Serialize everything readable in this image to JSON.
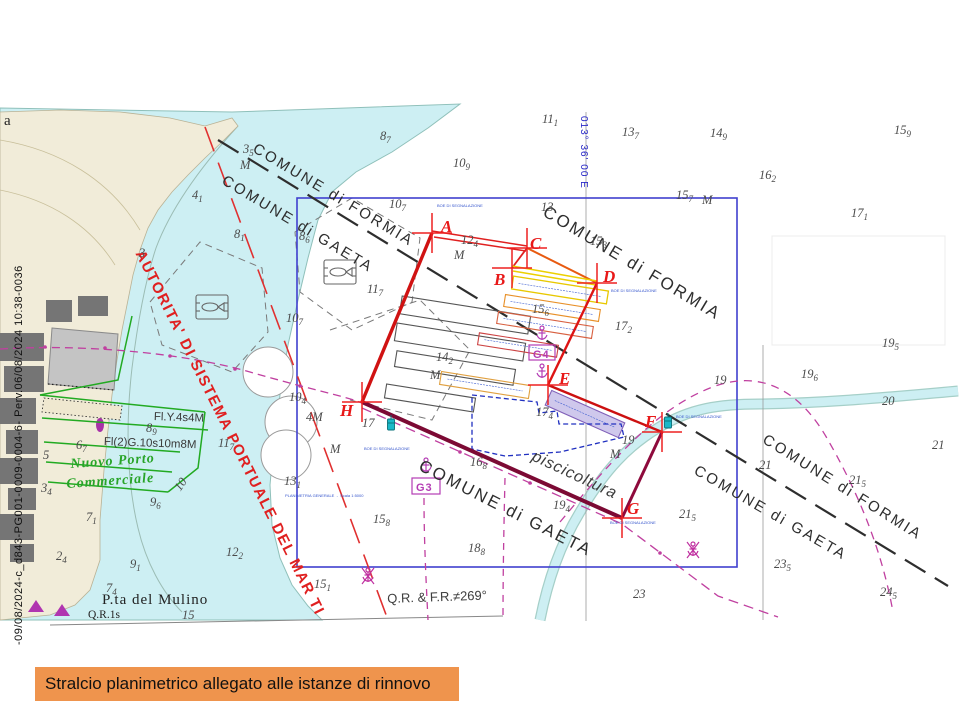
{
  "page": {
    "caption": "Stralcio planimetrico allegato alle istanze di rinnovo",
    "reference_vertical": "-09/08/2024-c_d843-PG001-0009-0004-6- Perv.06/08/2024 10:38-0036"
  },
  "colors": {
    "caption_bg": "#ef944d",
    "shallow_water": "#cdeff3",
    "land": "#f1ecd9",
    "polygon_red": "#d01212",
    "polygon_dark": "#7c0a34",
    "cage_yellow": "#e8c800",
    "cage_orange": "#e89028",
    "magenta_cable": "#c040a0",
    "frame_blue": "#4040cf",
    "authority_red": "#e02020",
    "green_port": "#28a428",
    "buoy_teal": "#1ab8c8"
  },
  "chart": {
    "labels": [
      {
        "name": "comune-formia-1",
        "text": "COMUNE di FORMIA",
        "x": 258,
        "y": 141,
        "rot": 31,
        "cls": "comune"
      },
      {
        "name": "comune-gaeta-1",
        "text": "COMUNE di GAETA",
        "x": 227,
        "y": 173,
        "rot": 31,
        "cls": "comune"
      },
      {
        "name": "comune-formia-2",
        "text": "COMUNE di FORMIA",
        "x": 549,
        "y": 203,
        "rot": 31,
        "cls": "comune-lg"
      },
      {
        "name": "comune-gaeta-2",
        "text": "COMUNE di GAETA",
        "x": 424,
        "y": 457,
        "rot": 27,
        "cls": "comune-lg"
      },
      {
        "name": "comune-formia-3",
        "text": "COMUNE di FORMIA",
        "x": 768,
        "y": 432,
        "rot": 32,
        "cls": "comune"
      },
      {
        "name": "comune-gaeta-3",
        "text": "COMUNE di GAETA",
        "x": 699,
        "y": 463,
        "rot": 30,
        "cls": "comune"
      },
      {
        "name": "piscicoltura-label",
        "text": "piscicoltura",
        "x": 536,
        "y": 449,
        "rot": 25,
        "cls": "pisci"
      },
      {
        "name": "port-authority-label",
        "text": "AUTORITA' DI SISTEMA PORTUALE DEL MAR TI",
        "x": 146,
        "y": 248,
        "rot": 63.5,
        "cls": "autorita"
      },
      {
        "name": "nuovo-porto-line1",
        "text": "Nuovo Porto",
        "x": 70,
        "y": 458,
        "rot": -4,
        "cls": "green-it"
      },
      {
        "name": "nuovo-porto-line2",
        "text": "Commerciale",
        "x": 66,
        "y": 478,
        "rot": -4,
        "cls": "green-it"
      },
      {
        "name": "light-char-1",
        "text": "Fl.Y.4s4M",
        "x": 154,
        "y": 412,
        "rot": 2,
        "cls": "light"
      },
      {
        "name": "light-char-2",
        "text": "Fl(2)G.10s10m8M",
        "x": 104,
        "y": 437,
        "rot": 2,
        "cls": "light"
      },
      {
        "name": "pta-del-mulino",
        "text": "P.ta del Mulino",
        "x": 102,
        "y": 593,
        "rot": 0,
        "cls": "place"
      },
      {
        "name": "light-char-3",
        "text": "Q.R.1s",
        "x": 88,
        "y": 610,
        "rot": 0,
        "cls": "place-sm"
      },
      {
        "name": "bearing-note",
        "text": "Q.R. & F.R.≠269°",
        "x": 387,
        "y": 592,
        "rot": -2,
        "cls": "qr"
      },
      {
        "name": "planimetria-note",
        "text": "PLANIMETRIA GENERALE  -  Scala 1:5000",
        "x": 285,
        "y": 494,
        "rot": 0,
        "cls": "tinyblue"
      },
      {
        "name": "boe-label-a",
        "text": "BOE DI SEGNALAZIONE",
        "x": 437,
        "y": 204,
        "rot": 0,
        "cls": "tinyblue"
      },
      {
        "name": "boe-label-d",
        "text": "BOE DI SEGNALAZIONE",
        "x": 611,
        "y": 289,
        "rot": 0,
        "cls": "tinyblue"
      },
      {
        "name": "boe-label-h",
        "text": "BOE DI SEGNALAZIONE",
        "x": 364,
        "y": 447,
        "rot": 0,
        "cls": "tinyblue"
      },
      {
        "name": "boe-label-f",
        "text": "BOE DI SEGNALAZIONE",
        "x": 676,
        "y": 415,
        "rot": 0,
        "cls": "tinyblue"
      },
      {
        "name": "boe-label-g",
        "text": "BOE DI SEGNALAZIONE",
        "x": 610,
        "y": 521,
        "rot": 0,
        "cls": "tinyblue"
      },
      {
        "name": "anchorage-g3",
        "text": "G3",
        "x": 416,
        "y": 483,
        "rot": 0,
        "cls": "gpt"
      },
      {
        "name": "anchorage-g4",
        "text": "G4",
        "x": 533,
        "y": 350,
        "rot": 0,
        "cls": "gpt"
      },
      {
        "name": "meridian-label",
        "text": "013° 36' 00 E",
        "x": 578,
        "y": 116,
        "rot": 0,
        "cls": "meridian"
      },
      {
        "name": "coast-placename-fragment",
        "text": "a",
        "x": 4,
        "y": 114,
        "rot": 0,
        "cls": "place"
      }
    ],
    "vertices": [
      {
        "label": "A",
        "x": 441,
        "y": 218
      },
      {
        "label": "B",
        "x": 494,
        "y": 271
      },
      {
        "label": "C",
        "x": 530,
        "y": 235
      },
      {
        "label": "D",
        "x": 603,
        "y": 268
      },
      {
        "label": "E",
        "x": 559,
        "y": 370
      },
      {
        "label": "F",
        "x": 645,
        "y": 413
      },
      {
        "label": "G",
        "x": 627,
        "y": 500
      },
      {
        "label": "H",
        "x": 340,
        "y": 402
      }
    ],
    "soundings": [
      {
        "x": 243,
        "y": 143,
        "m": "3",
        "s": "5"
      },
      {
        "x": 240,
        "y": 159,
        "m": "M",
        "s": ""
      },
      {
        "x": 192,
        "y": 189,
        "m": "4",
        "s": "1"
      },
      {
        "x": 139,
        "y": 247,
        "m": "3",
        "s": ""
      },
      {
        "x": 380,
        "y": 130,
        "m": "8",
        "s": "7"
      },
      {
        "x": 234,
        "y": 228,
        "m": "8",
        "s": "1"
      },
      {
        "x": 453,
        "y": 157,
        "m": "10",
        "s": "9"
      },
      {
        "x": 299,
        "y": 230,
        "m": "8",
        "s": "6"
      },
      {
        "x": 389,
        "y": 198,
        "m": "10",
        "s": "7"
      },
      {
        "x": 367,
        "y": 283,
        "m": "11",
        "s": "7"
      },
      {
        "x": 286,
        "y": 312,
        "m": "10",
        "s": "7"
      },
      {
        "x": 542,
        "y": 113,
        "m": "11",
        "s": "1"
      },
      {
        "x": 622,
        "y": 126,
        "m": "13",
        "s": "7"
      },
      {
        "x": 710,
        "y": 127,
        "m": "14",
        "s": "9"
      },
      {
        "x": 894,
        "y": 124,
        "m": "15",
        "s": "9"
      },
      {
        "x": 759,
        "y": 169,
        "m": "16",
        "s": "2"
      },
      {
        "x": 851,
        "y": 207,
        "m": "17",
        "s": "1"
      },
      {
        "x": 676,
        "y": 189,
        "m": "15",
        "s": "7"
      },
      {
        "x": 702,
        "y": 194,
        "m": "M",
        "s": ""
      },
      {
        "x": 541,
        "y": 201,
        "m": "13",
        "s": ""
      },
      {
        "x": 590,
        "y": 235,
        "m": "15",
        "s": "3"
      },
      {
        "x": 461,
        "y": 234,
        "m": "12",
        "s": "4"
      },
      {
        "x": 454,
        "y": 249,
        "m": "M",
        "s": ""
      },
      {
        "x": 532,
        "y": 303,
        "m": "15",
        "s": "6"
      },
      {
        "x": 615,
        "y": 320,
        "m": "17",
        "s": "2"
      },
      {
        "x": 436,
        "y": 351,
        "m": "14",
        "s": "2"
      },
      {
        "x": 430,
        "y": 369,
        "m": "M",
        "s": ""
      },
      {
        "x": 536,
        "y": 406,
        "m": "17",
        "s": "4"
      },
      {
        "x": 362,
        "y": 417,
        "m": "17",
        "s": ""
      },
      {
        "x": 330,
        "y": 443,
        "m": "M",
        "s": ""
      },
      {
        "x": 306,
        "y": 411,
        "m": "4M",
        "s": ""
      },
      {
        "x": 714,
        "y": 374,
        "m": "19",
        "s": ""
      },
      {
        "x": 622,
        "y": 434,
        "m": "19",
        "s": ""
      },
      {
        "x": 610,
        "y": 448,
        "m": "M",
        "s": ""
      },
      {
        "x": 470,
        "y": 456,
        "m": "16",
        "s": "8"
      },
      {
        "x": 553,
        "y": 499,
        "m": "19",
        "s": "4"
      },
      {
        "x": 373,
        "y": 513,
        "m": "15",
        "s": "8"
      },
      {
        "x": 468,
        "y": 542,
        "m": "18",
        "s": "8"
      },
      {
        "x": 284,
        "y": 475,
        "m": "13",
        "s": "1"
      },
      {
        "x": 314,
        "y": 578,
        "m": "15",
        "s": "1"
      },
      {
        "x": 882,
        "y": 337,
        "m": "19",
        "s": "5"
      },
      {
        "x": 801,
        "y": 368,
        "m": "19",
        "s": "6"
      },
      {
        "x": 882,
        "y": 395,
        "m": "20",
        "s": ""
      },
      {
        "x": 932,
        "y": 439,
        "m": "21",
        "s": ""
      },
      {
        "x": 759,
        "y": 459,
        "m": "21",
        "s": ""
      },
      {
        "x": 679,
        "y": 508,
        "m": "21",
        "s": "5"
      },
      {
        "x": 849,
        "y": 474,
        "m": "21",
        "s": "5"
      },
      {
        "x": 774,
        "y": 558,
        "m": "23",
        "s": "5"
      },
      {
        "x": 633,
        "y": 588,
        "m": "23",
        "s": ""
      },
      {
        "x": 880,
        "y": 586,
        "m": "24",
        "s": "5"
      },
      {
        "x": 43,
        "y": 449,
        "m": "5",
        "s": ""
      },
      {
        "x": 76,
        "y": 439,
        "m": "6",
        "s": "7"
      },
      {
        "x": 41,
        "y": 482,
        "m": "3",
        "s": "4"
      },
      {
        "x": 86,
        "y": 511,
        "m": "7",
        "s": "1"
      },
      {
        "x": 56,
        "y": 550,
        "m": "2",
        "s": "4"
      },
      {
        "x": 106,
        "y": 582,
        "m": "7",
        "s": "4"
      },
      {
        "x": 130,
        "y": 558,
        "m": "9",
        "s": "1"
      },
      {
        "x": 150,
        "y": 496,
        "m": "9",
        "s": "6"
      },
      {
        "x": 146,
        "y": 422,
        "m": "8",
        "s": "9"
      },
      {
        "x": 218,
        "y": 437,
        "m": "11",
        "s": "7"
      },
      {
        "x": 226,
        "y": 546,
        "m": "12",
        "s": "2"
      },
      {
        "x": 182,
        "y": 609,
        "m": "15",
        "s": ""
      },
      {
        "x": 172,
        "y": 486,
        "m": "10",
        "s": "",
        "rot": -55
      },
      {
        "x": 289,
        "y": 391,
        "m": "10",
        "s": "4"
      }
    ]
  }
}
